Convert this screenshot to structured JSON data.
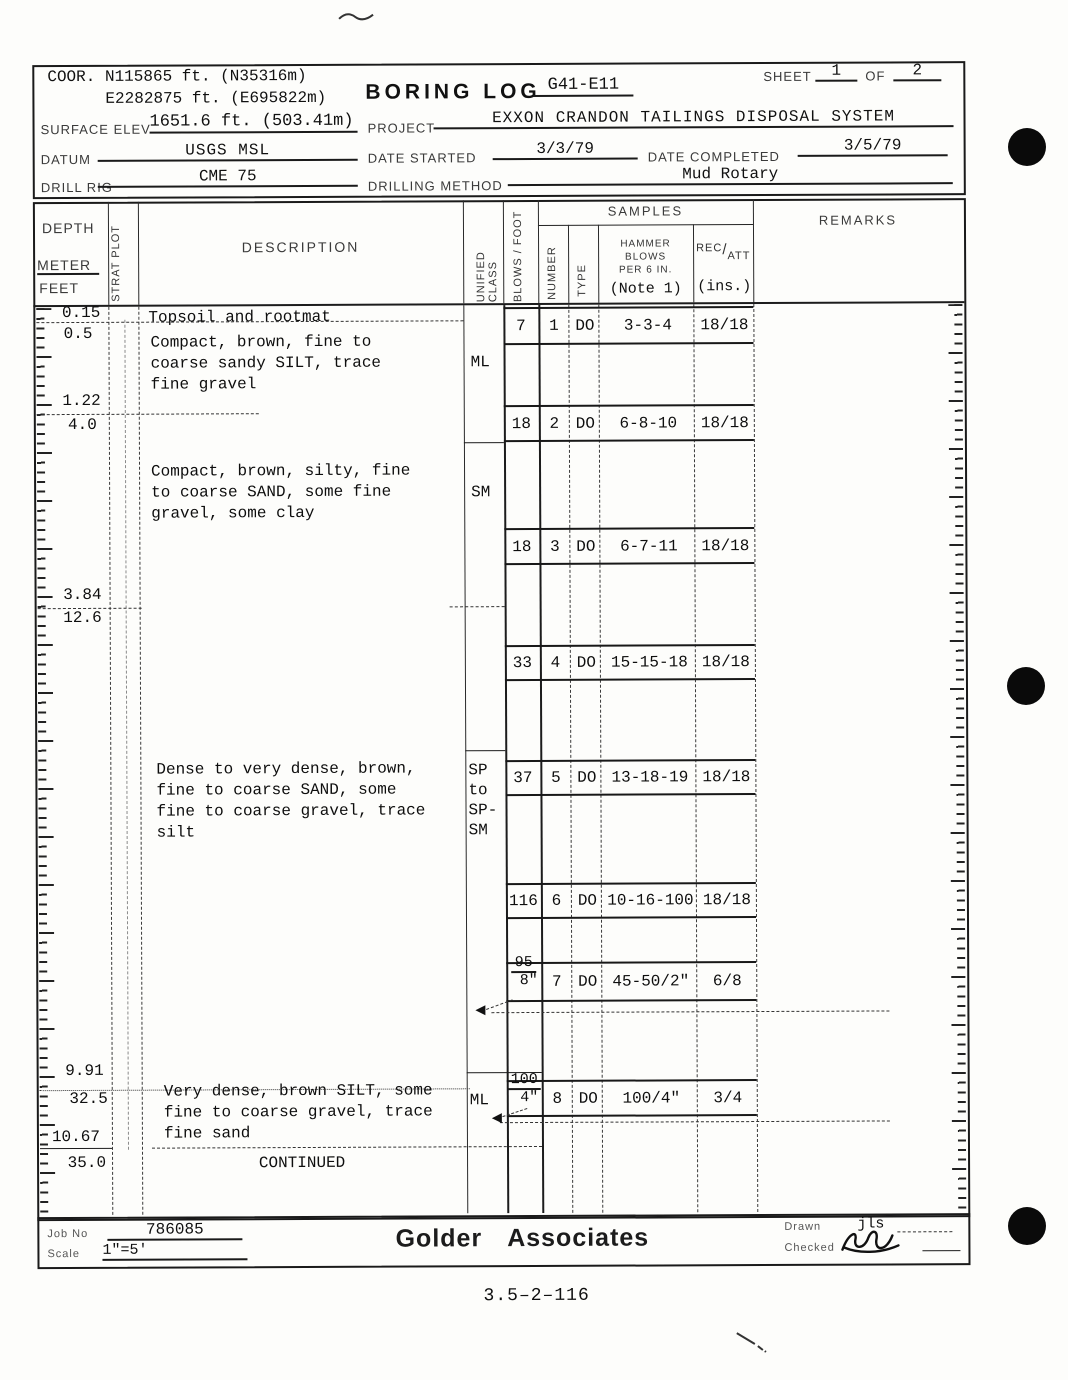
{
  "header": {
    "coor_label": "COOR.",
    "coor_north": "N115865 ft. (N35316m)",
    "coor_east": "E2282875 ft. (E695822m)",
    "title": "BORING LOG",
    "boring_id": "G41-E11",
    "sheet_label": "SHEET",
    "sheet_no": "1",
    "of_label": "OF",
    "sheet_total": "2",
    "surface_elev_label": "SURFACE ELEV",
    "surface_elev": "1651.6 ft. (503.41m)",
    "project_label": "PROJECT",
    "project": "EXXON CRANDON TAILINGS DISPOSAL SYSTEM",
    "datum_label": "DATUM",
    "datum": "USGS MSL",
    "date_started_label": "DATE STARTED",
    "date_started": "3/3/79",
    "date_completed_label": "DATE COMPLETED",
    "date_completed": "3/5/79",
    "drill_rig_label": "DRILL RIG",
    "drill_rig": "CME 75",
    "drilling_method_label": "DRILLING METHOD",
    "drilling_method": "Mud Rotary"
  },
  "columns": {
    "depth_label": "DEPTH",
    "meter_label": "METER",
    "feet_label": "FEET",
    "strat_plot_label": "STRAT PLOT",
    "description_label": "DESCRIPTION",
    "unified_class_label": "UNIFIED CLASS",
    "blows_foot_label": "BLOWS / FOOT",
    "samples_label": "SAMPLES",
    "number_label": "NUMBER",
    "type_label": "TYPE",
    "hammer_line1": "HAMMER",
    "hammer_line2": "BLOWS",
    "hammer_line3": "PER 6 IN.",
    "hammer_note": "(Note 1)",
    "rec_label": "REC",
    "slash": "/",
    "att_label": "ATT",
    "ins_label": "(ins.)",
    "remarks_label": "REMARKS"
  },
  "depths": [
    {
      "meters": "0.15",
      "feet": "0.5"
    },
    {
      "meters": "1.22",
      "feet": "4.0"
    },
    {
      "meters": "3.84",
      "feet": "12.6"
    },
    {
      "meters": "9.91",
      "feet": "32.5"
    },
    {
      "meters": "10.67",
      "feet": "35.0"
    }
  ],
  "strata": [
    {
      "description": "Topsoil and rootmat"
    },
    {
      "description": "Compact, brown, fine to\ncoarse sandy SILT, trace\nfine gravel",
      "unified_class": "ML"
    },
    {
      "description": "Compact, brown, silty, fine\nto coarse SAND, some fine\ngravel, some clay",
      "unified_class": "SM"
    },
    {
      "description": "Dense to very dense, brown,\nfine to coarse SAND, some\nfine to coarse gravel, trace\nsilt",
      "unified_class": "SP\nto\nSP-\nSM"
    },
    {
      "description": "Very dense, brown SILT, some\nfine to coarse gravel, trace\nfine sand",
      "unified_class": "ML"
    },
    {
      "description": "CONTINUED"
    }
  ],
  "samples": [
    {
      "blows": "7",
      "number": "1",
      "type": "DO",
      "hammer": "3-3-4",
      "rec": "18/18"
    },
    {
      "blows": "18",
      "number": "2",
      "type": "DO",
      "hammer": "6-8-10",
      "rec": "18/18"
    },
    {
      "blows": "18",
      "number": "3",
      "type": "DO",
      "hammer": "6-7-11",
      "rec": "18/18"
    },
    {
      "blows": "33",
      "number": "4",
      "type": "DO",
      "hammer": "15-15-18",
      "rec": "18/18"
    },
    {
      "blows": "37",
      "number": "5",
      "type": "DO",
      "hammer": "13-18-19",
      "rec": "18/18"
    },
    {
      "blows": "116",
      "number": "6",
      "type": "DO",
      "hammer": "10-16-100",
      "rec": "18/18"
    },
    {
      "blows_top": "95",
      "blows_bottom": "8\"",
      "number": "7",
      "type": "DO",
      "hammer": "45-50/2\"",
      "rec": "6/8"
    },
    {
      "blows_top": "100",
      "blows_bottom": "4\"",
      "number": "8",
      "type": "DO",
      "hammer": "100/4\"",
      "rec": "3/4"
    }
  ],
  "footer": {
    "job_no_label": "Job No",
    "job_no": "786085",
    "scale_label": "Scale",
    "scale": "1\"=5'",
    "company": "Golder Associates",
    "drawn_label": "Drawn",
    "drawn": "jls",
    "checked_label": "Checked"
  },
  "page": {
    "bottom_code": "3.5–2–116"
  }
}
